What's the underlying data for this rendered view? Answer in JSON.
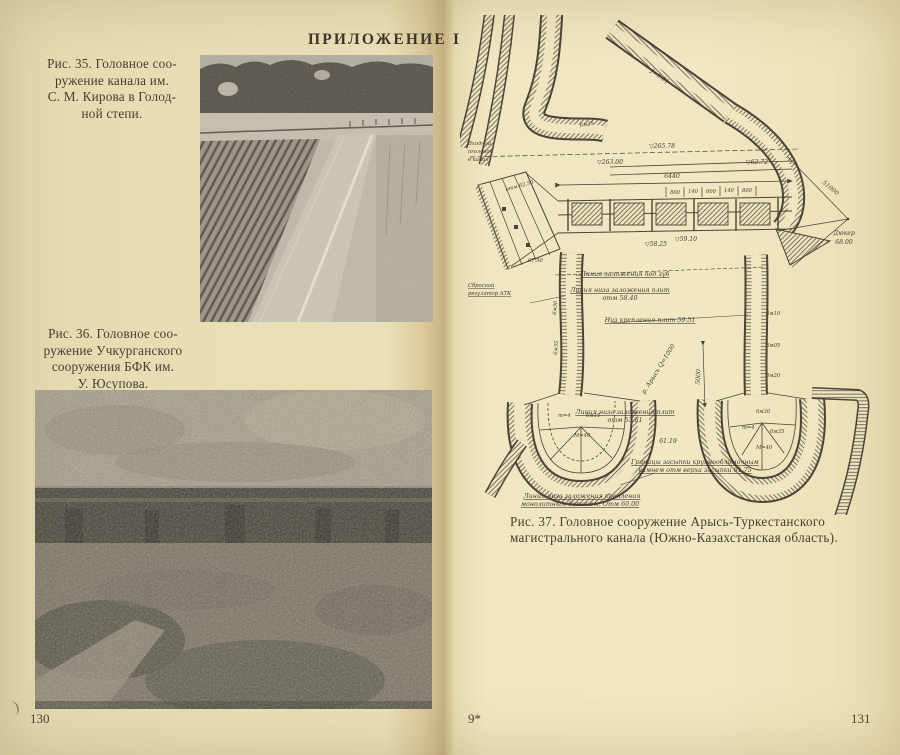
{
  "header": {
    "title": "ПРИЛОЖЕНИЕ I"
  },
  "colors": {
    "paper_left": "#eadfb6",
    "paper_right": "#f0e6c1",
    "ink": "#4b4439",
    "photo_gray": "#8c856f"
  },
  "left_page": {
    "caption35": {
      "lines": [
        "Рис. 35.  Головное соо-",
        "ружение  канала  им.",
        "С. М. Кирова  в  Голод-",
        "ной степи."
      ]
    },
    "caption36": {
      "lines": [
        "Рис. 36.  Головное  соо-",
        "ружение  Учкурганского",
        "сооружения  БФК  им.",
        "У. Юсупова."
      ]
    },
    "photo35": "photo-canal-kirov",
    "photo36": "photo-headworks-uchkurgan",
    "page_number": "130",
    "corner_mark": ")"
  },
  "right_page": {
    "caption37": {
      "lines": [
        "Рис. 37. Головное сооружение Арысь-Туркестанского",
        "магистрального канала (Южно-Казахстанская область)."
      ]
    },
    "signature_mark": "9*",
    "page_number": "131",
    "diagram": {
      "inlet_l1": "Входной",
      "inlet_l2": "оголовок",
      "inlet_l3": "в канал",
      "spill_l1": "Сбросной",
      "spill_l2": "регулятор АТК",
      "slope": "J=0.01",
      "ch_6m25": "6м25",
      "elev_26578": "▽265.78",
      "elev_26300": "▽263.00",
      "elev_6272": "▽62.72",
      "dim_total": "6440",
      "dims": [
        "800",
        "140",
        "600",
        "140",
        "800"
      ],
      "elev_5825": "▽58.25",
      "elev_5910": "▽59.10",
      "fan_top": "отм 62.50",
      "fan_bot": "67.50",
      "radius": "51000",
      "duker_l1": "Дюкер",
      "duker_l2": "68.00",
      "ln_zub": "Линия заложения под зуб",
      "ln_5840_l1": "Линия низа заложения плит",
      "ln_5840_l2": "отм 58.40",
      "ln_5951": "Низ крепления плит 59.51",
      "river": "р. Арысь Q=1000",
      "dim_5000": "5000",
      "ln_5361_l1": "Линия низа заложения плит",
      "ln_5361_l2": "отм 53.61",
      "n_6119": "61.19",
      "ln_6175_l1": "Границы засыпки крупнообломочным",
      "ln_6175_l2": "камнем отм верха засыпки 61.75",
      "ln_6000_l1": "Линия низа заложения крепления",
      "ln_6000_l2": "монолитным бетоном.  Отм 60.00",
      "hsl": [
        "m=4",
        "6м15",
        "М=40"
      ],
      "hsr": [
        "6м30",
        "m=4",
        "6м35",
        "М=40"
      ],
      "chl": [
        "6м30",
        "6м35"
      ],
      "chr": [
        "6м10",
        "6м05",
        "5м20"
      ]
    }
  }
}
